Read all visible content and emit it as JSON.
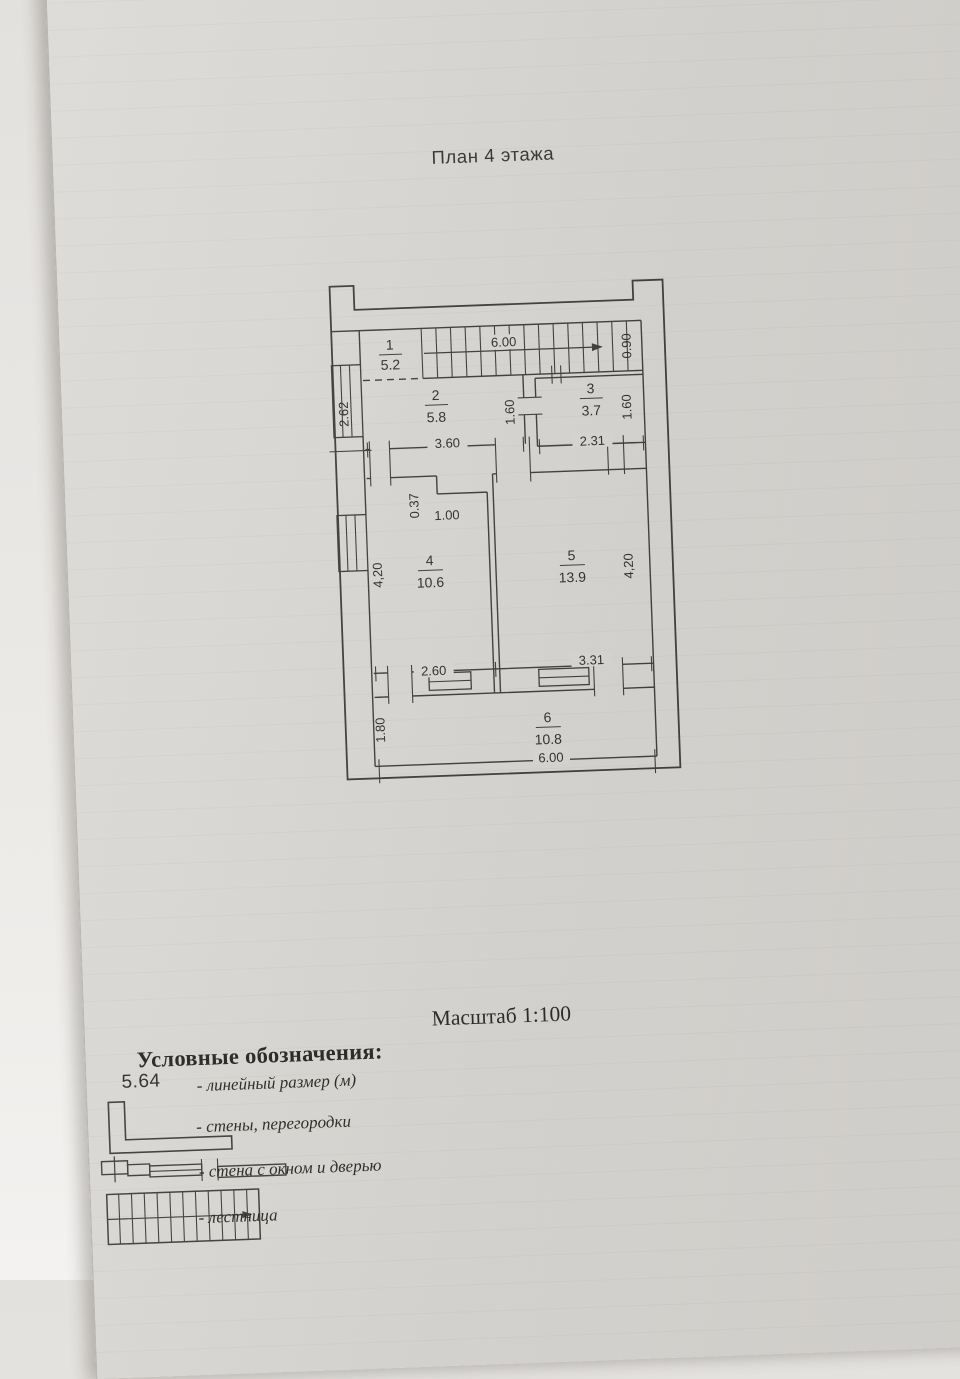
{
  "title": "План 4 этажа",
  "scale_label": "Масштаб 1:100",
  "legend": {
    "heading": "Условные обозначения:",
    "sample_value": "5.64",
    "linear_label": "- линейный размер (м)",
    "walls_label": "- стены, перегородки",
    "window_door_label": "- стена с окном и дверью",
    "stairs_label": "- лестница"
  },
  "rooms": [
    {
      "num": "1",
      "area": "5.2"
    },
    {
      "num": "2",
      "area": "5.8"
    },
    {
      "num": "3",
      "area": "3.7"
    },
    {
      "num": "4",
      "area": "10.6"
    },
    {
      "num": "5",
      "area": "13.9"
    },
    {
      "num": "6",
      "area": "10.8"
    }
  ],
  "dims": {
    "stair_len": "6.00",
    "stair_w": "0.90",
    "hall_h": "2.62",
    "r2_w": "3.60",
    "r2_h": "1.60",
    "r3_w": "2.31",
    "r3_h": "1.60",
    "notch_d": "0.37",
    "notch_w": "1.00",
    "r4_h": "4,20",
    "r5_h": "4,20",
    "r4_w": "2.60",
    "r5_w": "3.31",
    "balc_h": "1.80",
    "balc_w": "6.00"
  }
}
